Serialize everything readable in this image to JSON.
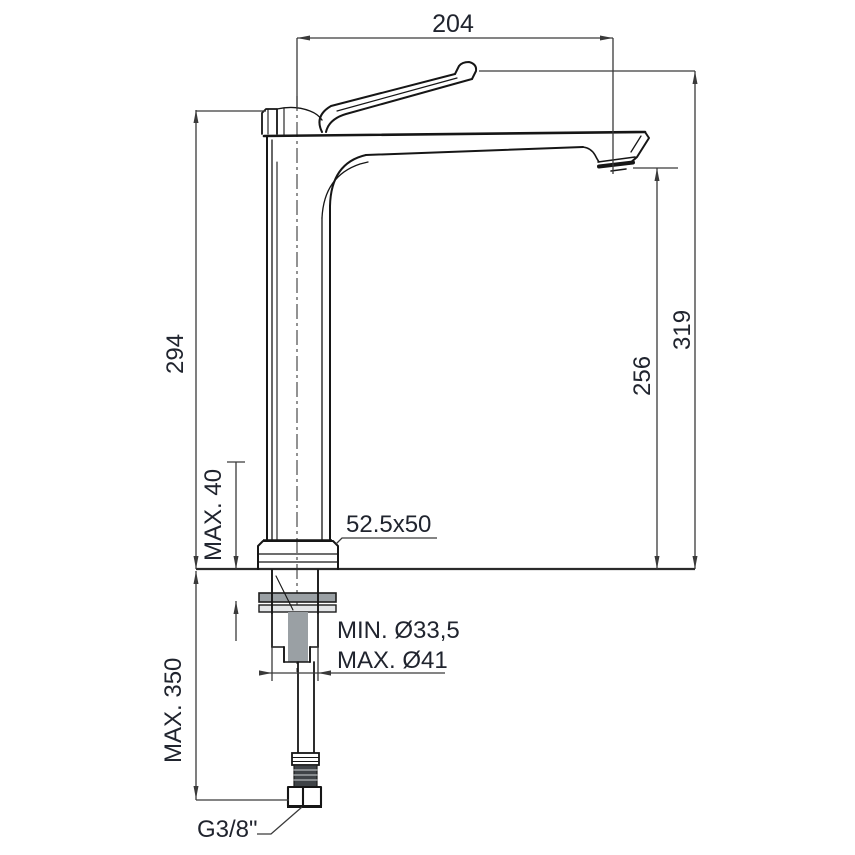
{
  "drawing": {
    "type": "technical-dimension-drawing",
    "subject": "tall single-lever basin mixer tap, side view",
    "labels": {
      "width_top": "204",
      "height_left": "294",
      "height_right_outer": "319",
      "height_right_inner": "256",
      "deck_max": "MAX. 40",
      "base_size": "52.5x50",
      "hole_min": "MIN. Ø33,5",
      "hole_max": "MAX. Ø41",
      "hose_max": "MAX. 350",
      "thread": "G3/8\""
    },
    "colors": {
      "object_line": "#161616",
      "dimension_line": "#3a3a3a",
      "text": "#20242e",
      "background": "#ffffff"
    }
  }
}
